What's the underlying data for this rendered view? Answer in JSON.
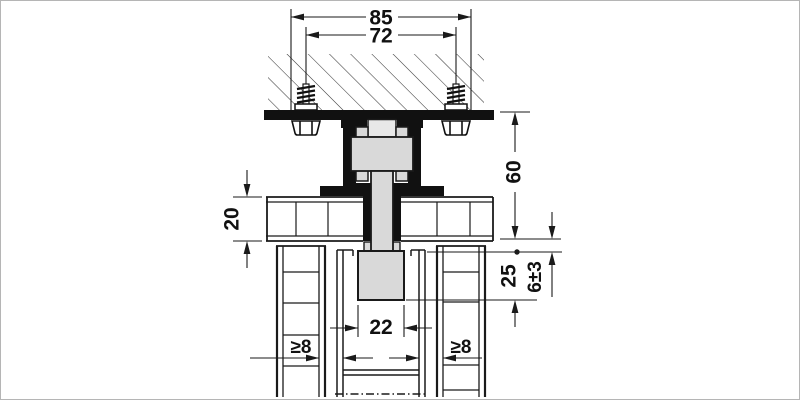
{
  "drawing": {
    "dimension_labels": {
      "top_outer": "85",
      "top_inner": "72",
      "right_height": "60",
      "left_thickness": "20",
      "right_depth": "25",
      "right_gap": "6±3",
      "center_width": "22",
      "min_left": "≥8",
      "min_right": "≥8"
    },
    "colors": {
      "line": "#1a1a1a",
      "solid_black": "#111111",
      "component_gray": "#d9d9d9",
      "background": "#ffffff",
      "frame_border": "#b5b5b5"
    }
  }
}
